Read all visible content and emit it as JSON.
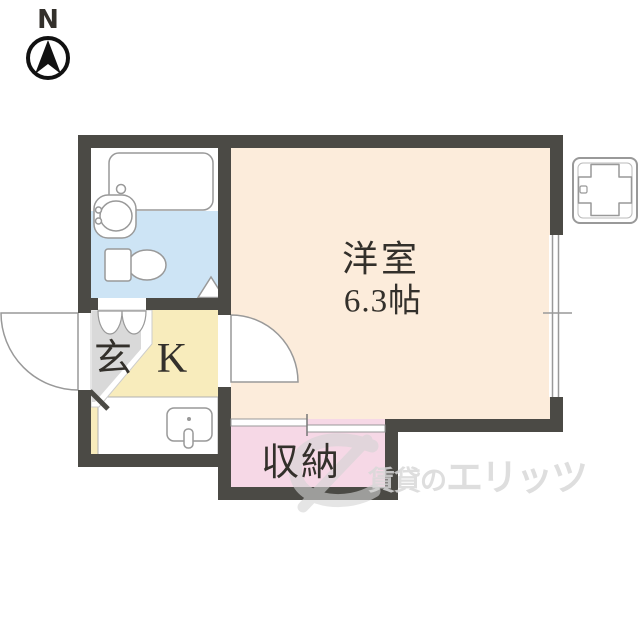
{
  "compass": {
    "north_label": "N"
  },
  "rooms": {
    "living": {
      "name": "洋室",
      "size": "6.3帖",
      "floor_color": "#fcecdb"
    },
    "kitchen": {
      "label": "K",
      "floor_color": "#f8ecbc"
    },
    "entrance": {
      "label": "玄",
      "floor_color": "#d9d9d9"
    },
    "closet": {
      "label": "収納",
      "floor_color": "#f6d8e6"
    },
    "bathroom": {
      "floor_color": "#cde4f5"
    }
  },
  "watermark": {
    "prefix": "賃貸の",
    "brand": "エリッツ",
    "color": "#d9d9d9"
  },
  "colors": {
    "wall": "#4b4a45",
    "fixture_outline": "#999999",
    "label_text": "#33302b",
    "background": "#ffffff",
    "compass": "#111111"
  },
  "fixtures": [
    {
      "name": "compass",
      "shape": "circle-with-north-needle"
    },
    {
      "name": "bathtub",
      "shape": "rounded-rect"
    },
    {
      "name": "washbasin",
      "shape": "ellipse-in-rounded-rect"
    },
    {
      "name": "toilet",
      "shape": "tank-and-bowl"
    },
    {
      "name": "curtain-door",
      "shape": "double-scallop"
    },
    {
      "name": "door-direction-triangle",
      "shape": "triangle"
    },
    {
      "name": "entrance-door",
      "shape": "quarter-circle-swing"
    },
    {
      "name": "living-room-door",
      "shape": "quarter-circle-swing"
    },
    {
      "name": "kitchen-sink",
      "shape": "rounded-rect-with-faucet"
    },
    {
      "name": "closet-sliding-door",
      "shape": "offset-double-rect"
    },
    {
      "name": "window",
      "shape": "double-line-in-wall"
    },
    {
      "name": "washing-machine-pan",
      "shape": "plus-in-square"
    }
  ]
}
